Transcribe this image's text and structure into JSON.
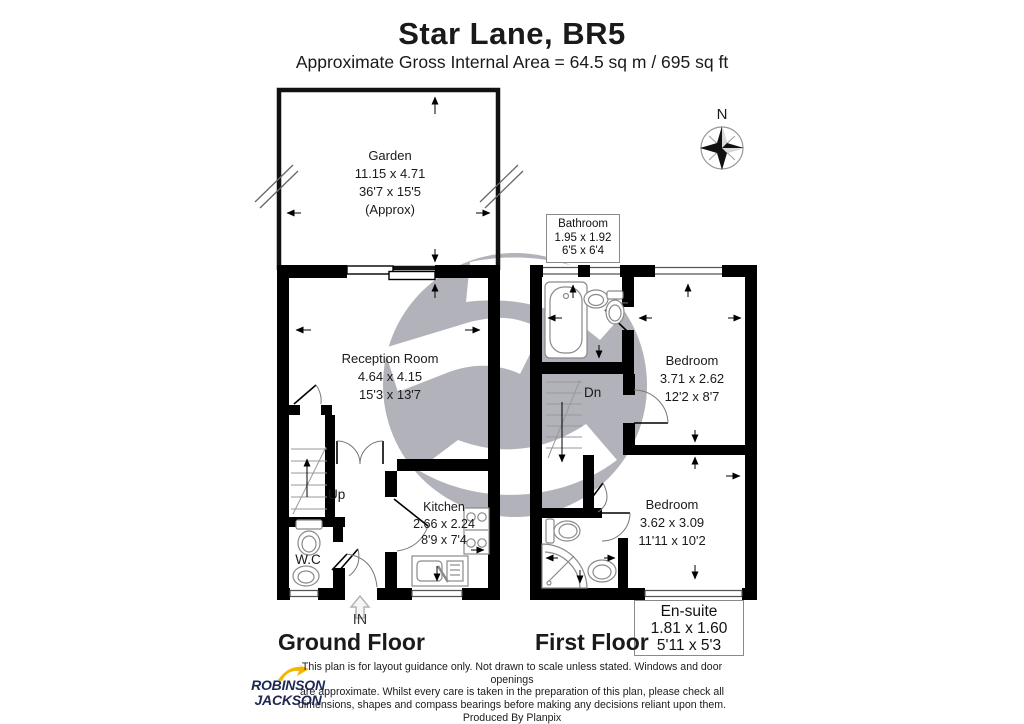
{
  "header": {
    "title": "Star Lane, BR5",
    "subtitle": "Approximate Gross Internal Area = 64.5 sq m / 695 sq ft"
  },
  "compass": {
    "north": "N"
  },
  "rooms": {
    "garden": {
      "name": "Garden",
      "metric": "11.15 x 4.71",
      "imperial": "36'7 x 15'5",
      "note": "(Approx)"
    },
    "reception": {
      "name": "Reception Room",
      "metric": "4.64 x 4.15",
      "imperial": "15'3 x 13'7"
    },
    "kitchen": {
      "name": "Kitchen",
      "metric": "2.66 x 2.24",
      "imperial": "8'9 x 7'4"
    },
    "wc": {
      "name": "W.C"
    },
    "bathroom": {
      "name": "Bathroom",
      "metric": "1.95 x 1.92",
      "imperial": "6'5 x 6'4"
    },
    "bedroom1": {
      "name": "Bedroom",
      "metric": "3.71 x 2.62",
      "imperial": "12'2 x 8'7"
    },
    "bedroom2": {
      "name": "Bedroom",
      "metric": "3.62 x 3.09",
      "imperial": "11'11 x 10'2"
    },
    "ensuite": {
      "name": "En-suite",
      "metric": "1.81 x 1.60",
      "imperial": "5'11 x 5'3"
    }
  },
  "plan_labels": {
    "up": "Up",
    "down": "Dn",
    "entrance": "IN",
    "ground_floor": "Ground Floor",
    "first_floor": "First Floor"
  },
  "footer": {
    "disclaimer_lines": [
      "This plan is for layout guidance only. Not drawn to scale unless stated. Windows and door openings",
      "are approximate. Whilst every care is taken in the preparation of this plan, please check all",
      "dimensions, shapes and compass bearings before making any decisions reliant upon them.",
      "Produced By Planpix"
    ],
    "brand_line1": "ROBINSON",
    "brand_line2": "JACKSON"
  },
  "colors": {
    "wall": "#000000",
    "watermark_gray": "#b2b2ba",
    "brand_navy": "#1d2753",
    "brand_yellow": "#f2b600"
  }
}
